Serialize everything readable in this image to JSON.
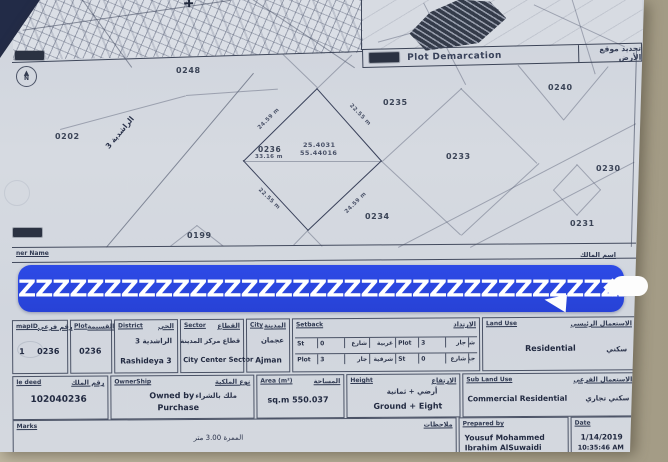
{
  "photo": {
    "background_color": "#b2aa93",
    "corner_shadow_color": "#222b47",
    "paper_color": "#d2d7df",
    "redaction_color": "#2b4ae3"
  },
  "header": {
    "title_en": "Plot Demarcation",
    "title_ar": "تحديد موقع الأرض"
  },
  "compass": {
    "label": "N",
    "arrow": "▲"
  },
  "plat": {
    "plots": [
      {
        "label": "0248"
      },
      {
        "label": "0235"
      },
      {
        "label": "0240"
      },
      {
        "label": "0202"
      },
      {
        "label": "0233"
      },
      {
        "label": "0230"
      },
      {
        "label": "0234"
      },
      {
        "label": "0231"
      },
      {
        "label": "0199"
      }
    ],
    "road_label_ar": "الراشدية 3",
    "parcel": {
      "number": "0236",
      "latitude": "25.4031",
      "longitude": "55.44016",
      "width": "33.16 m",
      "edge_top_left": "24.59 m",
      "edge_top_right": "22.55 m",
      "edge_bottom_left": "22.55 m",
      "edge_bottom_right": "24.59 m"
    },
    "owner_row": {
      "label_en": "ner Name",
      "label_ar": "اسم المالك"
    }
  },
  "redaction": {
    "text": "ZZZZZZZZZZZZZZZZZZZZZZZZZZZZZZZZZZZZZ"
  },
  "table": {
    "mapid": {
      "header_en": "mapID",
      "header_ar": "رقم فرعي",
      "value1": "1",
      "value2": "0236"
    },
    "plot": {
      "header_en": "Plot",
      "header_ar": "القسيمة",
      "value": "0236"
    },
    "district": {
      "header_en": "District",
      "header_ar": "الحي",
      "value_ar": "الراشدية 3",
      "value_en": "Rashideya 3"
    },
    "sector": {
      "header_en": "Sector",
      "header_ar": "القطاع",
      "value_ar": "قطاع مركز المدينة",
      "value_en": "City Center Sector"
    },
    "city": {
      "header_en": "City",
      "header_ar": "المدينة",
      "value_ar": "عجمان",
      "value_en": "Ajman"
    },
    "setback": {
      "header_en": "Setback",
      "header_ar": "الارتداد",
      "rows": [
        {
          "c1_type": "St",
          "c1_val": "0",
          "c1_unit": "شارع",
          "c1_side": "غربية",
          "c2_type": "Plot",
          "c2_val": "3",
          "c2_unit": "جار",
          "c2_side": "شمالية"
        },
        {
          "c1_type": "Plot",
          "c1_val": "3",
          "c1_unit": "جار",
          "c1_side": "شرقية",
          "c2_type": "St",
          "c2_val": "0",
          "c2_unit": "شارع",
          "c2_side": "جنوبية"
        }
      ]
    },
    "land_use": {
      "header_en": "Land Use",
      "header_ar": "الاستعمال الرئيسي",
      "value_en": "Residential",
      "value_ar": "سكني"
    },
    "deed": {
      "header_en": "le deed",
      "header_ar": "رقم الملك",
      "value": "102040236"
    },
    "ownership": {
      "header_en": "OwnerShip",
      "header_ar": "نوع الملكية",
      "value_en1": "Owned by",
      "value_ar": "ملك بالشراء",
      "value_en2": "Purchase"
    },
    "area": {
      "header_en": "Area (m²)",
      "header_ar": "المساحة",
      "value": "sq.m  550.037"
    },
    "height": {
      "header_en": "Height",
      "header_ar": "الارتفاع",
      "value_ar": "أرضي + ثمانية",
      "value_en": "Ground + Eight"
    },
    "sub_land_use": {
      "header_en": "Sub Land Use",
      "header_ar": "الاستعمال الفرعي",
      "value_en": "Commercial Residential",
      "value_ar": "سكني تجاري"
    },
    "remarks": {
      "header_en": "Marks",
      "header_ar": "ملاحظات",
      "note_ar": "الممرة 3.00 متر"
    },
    "prepared_by": {
      "header_en": "Prepared by",
      "name_line1": "Yousuf Mohammed",
      "name_line2": "Ibrahim AlSuwaidi"
    },
    "date": {
      "header_en": "Date",
      "value": "1/14/2019",
      "time_partial": "10:35:46 AM"
    }
  }
}
